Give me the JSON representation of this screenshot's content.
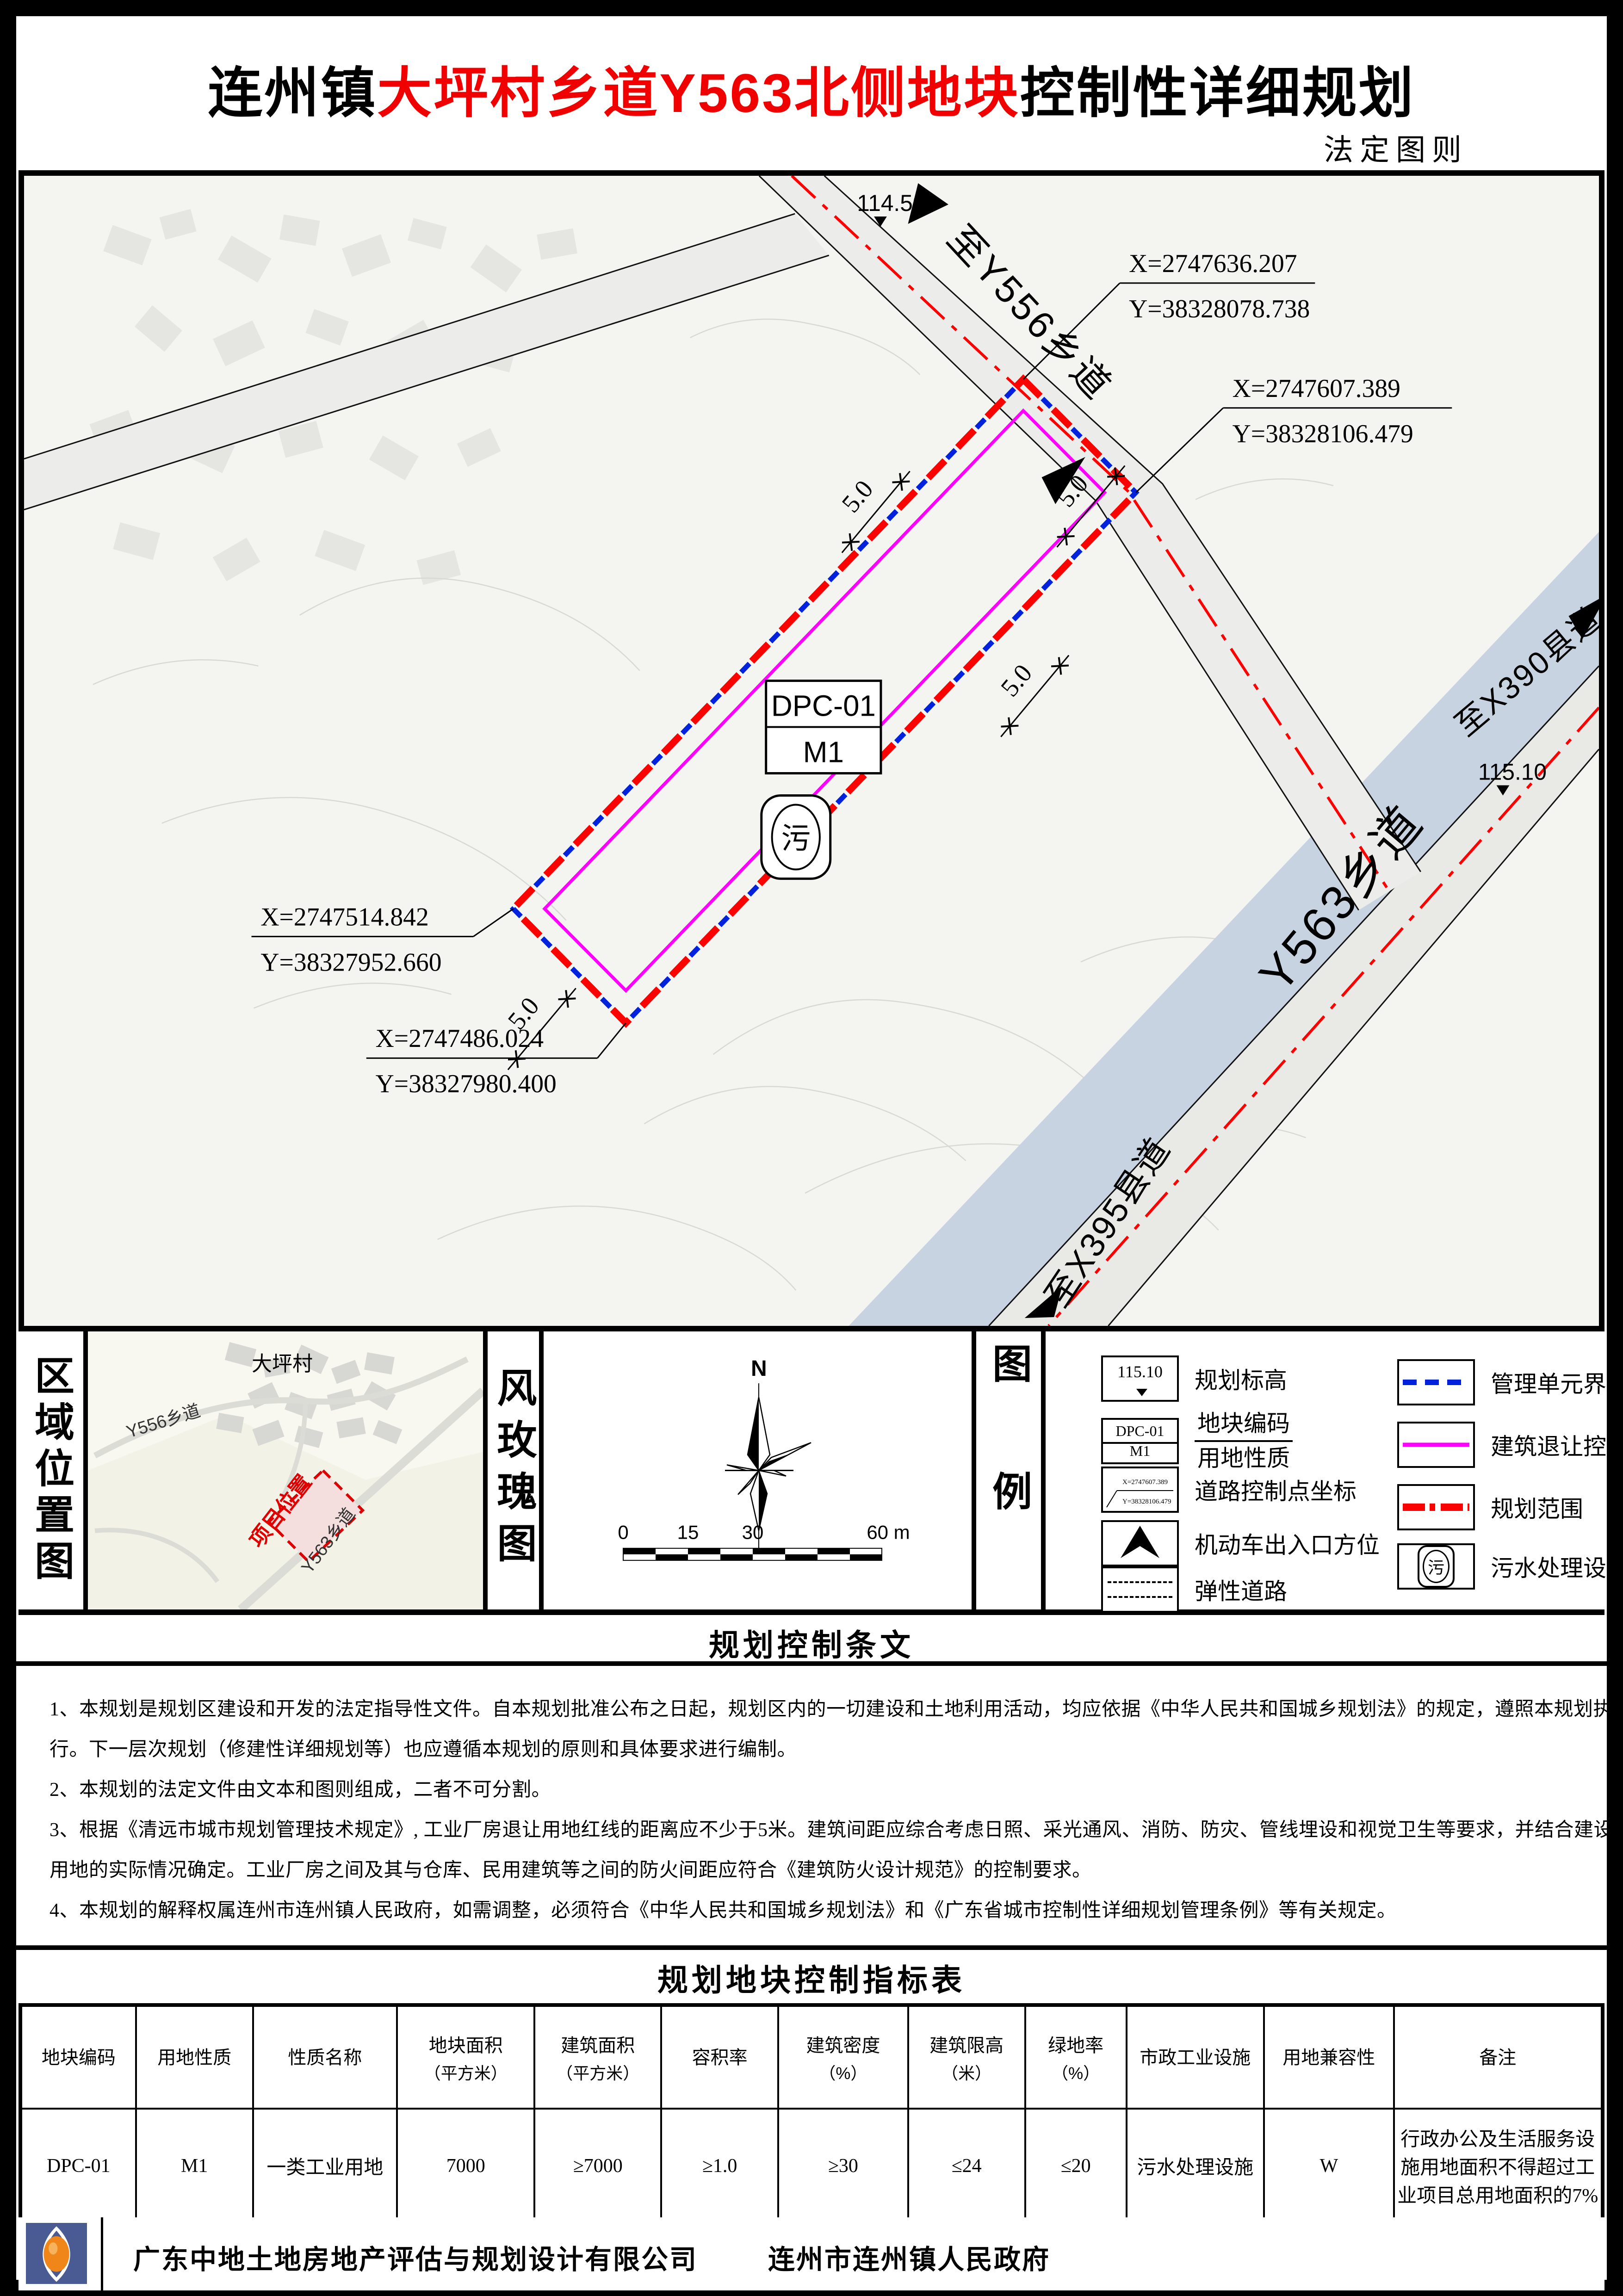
{
  "page": {
    "title_prefix": "连州镇",
    "title_highlight": "大坪村乡道Y563北侧地块",
    "title_suffix": "控制性详细规划",
    "subtitle": "法定图则"
  },
  "map": {
    "labels": {
      "to_y556": "至Y556乡道",
      "to_x390": "至X390县道",
      "y563": "Y563乡道",
      "to_x395": "至X395县道"
    },
    "elevations": {
      "north": "114.50",
      "east": "115.10"
    },
    "plot": {
      "code": "DPC-01",
      "use_code": "M1",
      "sewage_glyph": "污"
    },
    "setback": {
      "s1": "5.0",
      "s2": "5.0",
      "s3": "5.0",
      "s4": "5.0"
    },
    "control_points": [
      {
        "x": "X=2747636.207",
        "y": "Y=38328078.738"
      },
      {
        "x": "X=2747607.389",
        "y": "Y=38328106.479"
      },
      {
        "x": "X=2747514.842",
        "y": "Y=38327952.660"
      },
      {
        "x": "X=2747486.024",
        "y": "Y=38327980.400"
      }
    ]
  },
  "location_panel": {
    "title": "区域位置图",
    "village": "大坪村",
    "road_y556": "Y556乡道",
    "road_y563": "Y563乡道",
    "site": "项目位置"
  },
  "windrose_panel": {
    "title": "风玫瑰图",
    "north": "N",
    "scale": {
      "t0": "0",
      "t15": "15",
      "t30": "30",
      "t60": "60 m"
    }
  },
  "legend_panel": {
    "title": "图例",
    "left": [
      {
        "label": "规划标高",
        "value": "115.10"
      },
      {
        "label_top": "地块编码",
        "label_bottom": "用地性质",
        "code": "DPC-01",
        "use": "M1"
      },
      {
        "label": "道路控制点坐标",
        "x": "X=2747607.389",
        "y": "Y=38328106.479"
      },
      {
        "label": "机动车出入口方位"
      },
      {
        "label": "弹性道路"
      }
    ],
    "right": [
      {
        "label": "管理单元界线"
      },
      {
        "label": "建筑退让控制线"
      },
      {
        "label": "规划范围"
      },
      {
        "label": "污水处理设施",
        "glyph": "污"
      }
    ]
  },
  "provisions": {
    "title": "规划控制条文",
    "lines": [
      "1、本规划是规划区建设和开发的法定指导性文件。自本规划批准公布之日起，规划区内的一切建设和土地利用活动，均应依据《中华人民共和国城乡规划法》的规定，遵照本规划执",
      "行。下一层次规划（修建性详细规划等）也应遵循本规划的原则和具体要求进行编制。",
      "2、本规划的法定文件由文本和图则组成，二者不可分割。",
      "3、根据《清远市城市规划管理技术规定》, 工业厂房退让用地红线的距离应不少于5米。建筑间距应综合考虑日照、采光通风、消防、防灾、管线埋设和视觉卫生等要求，并结合建设",
      "用地的实际情况确定。工业厂房之间及其与仓库、民用建筑等之间的防火间距应符合《建筑防火设计规范》的控制要求。",
      "4、本规划的解释权属连州市连州镇人民政府，如需调整，必须符合《中华人民共和国城乡规划法》和《广东省城市控制性详细规划管理条例》等有关规定。"
    ]
  },
  "indicator_table": {
    "title": "规划地块控制指标表",
    "headers": [
      {
        "l1": "地块编码",
        "l2": ""
      },
      {
        "l1": "用地性质",
        "l2": ""
      },
      {
        "l1": "性质名称",
        "l2": ""
      },
      {
        "l1": "地块面积",
        "l2": "（平方米）"
      },
      {
        "l1": "建筑面积",
        "l2": "（平方米）"
      },
      {
        "l1": "容积率",
        "l2": ""
      },
      {
        "l1": "建筑密度",
        "l2": "（%）"
      },
      {
        "l1": "建筑限高",
        "l2": "（米）"
      },
      {
        "l1": "绿地率",
        "l2": "（%）"
      },
      {
        "l1": "市政工业设施",
        "l2": ""
      },
      {
        "l1": "用地兼容性",
        "l2": ""
      },
      {
        "l1": "备注",
        "l2": ""
      }
    ],
    "row": [
      "DPC-01",
      "M1",
      "一类工业用地",
      "7000",
      "≥7000",
      "≥1.0",
      "≥30",
      "≤24",
      "≤20",
      "污水处理设施",
      "W",
      "行政办公及生活服务设施用地面积不得超过工业项目总用地面积的7%"
    ]
  },
  "footer": {
    "company": "广东中地土地房地产评估与规划设计有限公司",
    "government": "连州市连州镇人民政府"
  },
  "colors": {
    "accent_red": "#ff0000",
    "boundary_blue": "#0022dd",
    "setback_magenta": "#ff00ff",
    "river_blue": "#c8d3e2"
  }
}
